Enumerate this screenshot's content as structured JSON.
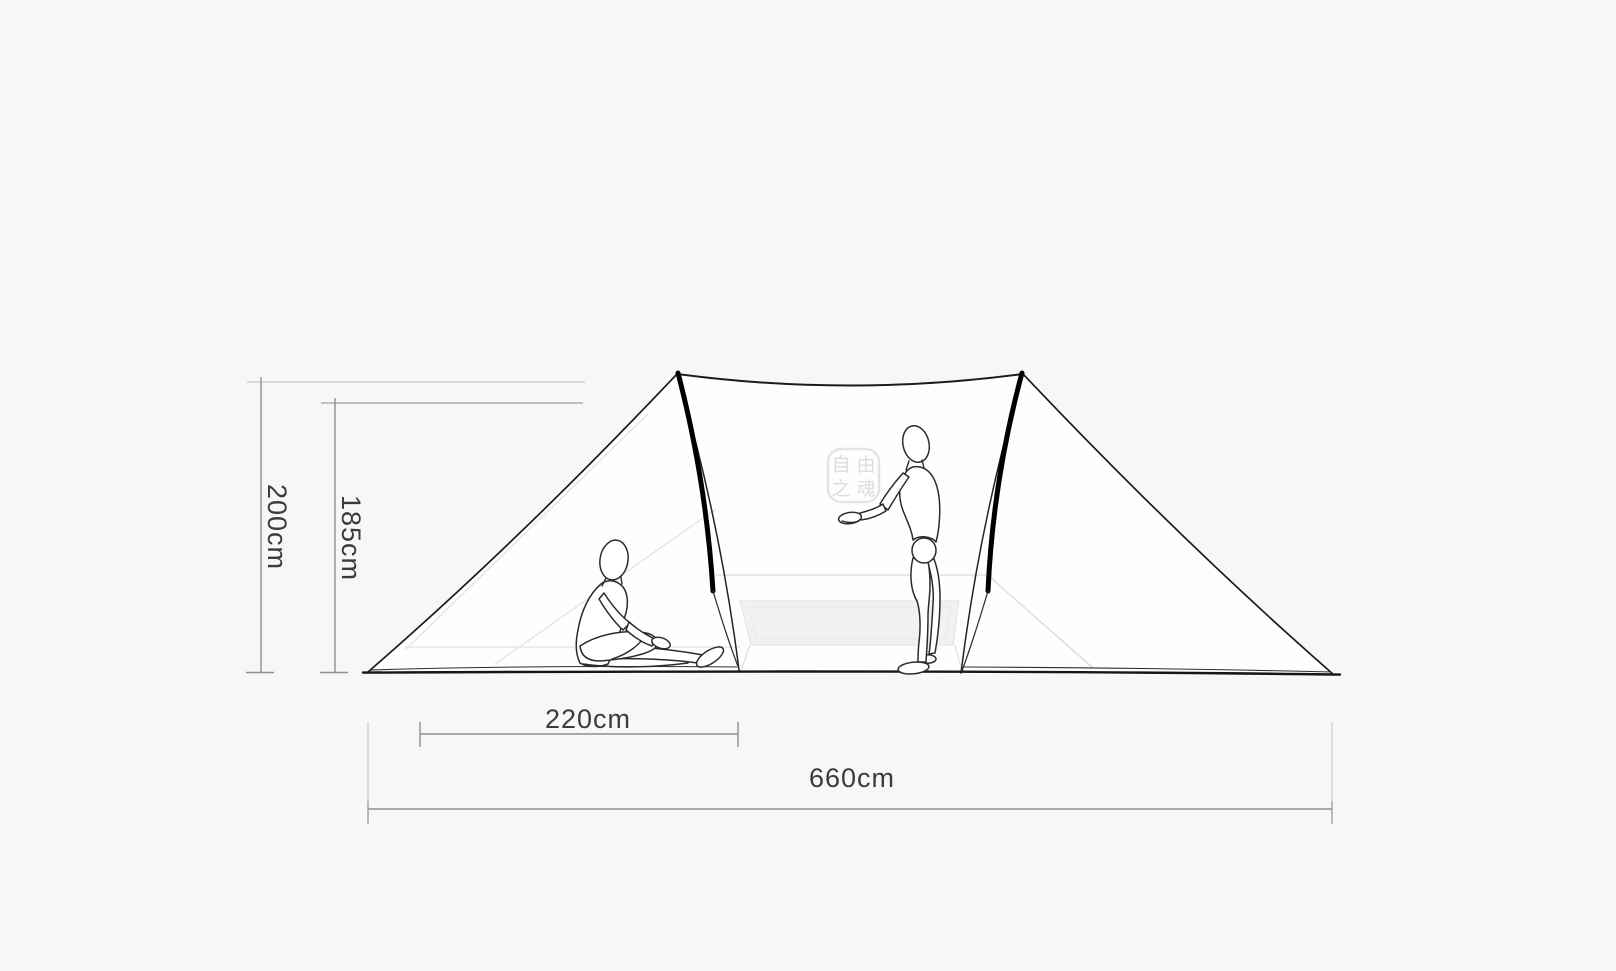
{
  "page": {
    "background": "#f7f7f7",
    "type": "product-dimension-diagram"
  },
  "diagram": {
    "subject": "tent side-view line drawing with two mannequin figures",
    "dimensions": {
      "total_height": {
        "label": "200cm",
        "value_cm": 200,
        "orientation": "vertical"
      },
      "inner_height": {
        "label": "185cm",
        "value_cm": 185,
        "orientation": "vertical"
      },
      "vestibule_width": {
        "label": "220cm",
        "value_cm": 220,
        "orientation": "horizontal"
      },
      "total_width": {
        "label": "660cm",
        "value_cm": 660,
        "orientation": "horizontal"
      }
    },
    "logo": {
      "shape": "rounded-square-seal-stamp",
      "chars": [
        "自",
        "由",
        "之",
        "魂"
      ]
    },
    "figures": [
      "sitting-person",
      "standing-person"
    ],
    "colors": {
      "background": "#f7f7f7",
      "tent_fill": "#fefefe",
      "outline": "#1b1b1b",
      "pole": "#000000",
      "dim_line": "#8f8f8f",
      "ext_line": "#c9c9c9",
      "label": "#3b3b3b",
      "floor_mat": "#f1f1f1",
      "faint_seam": "#e2e2e2"
    }
  }
}
